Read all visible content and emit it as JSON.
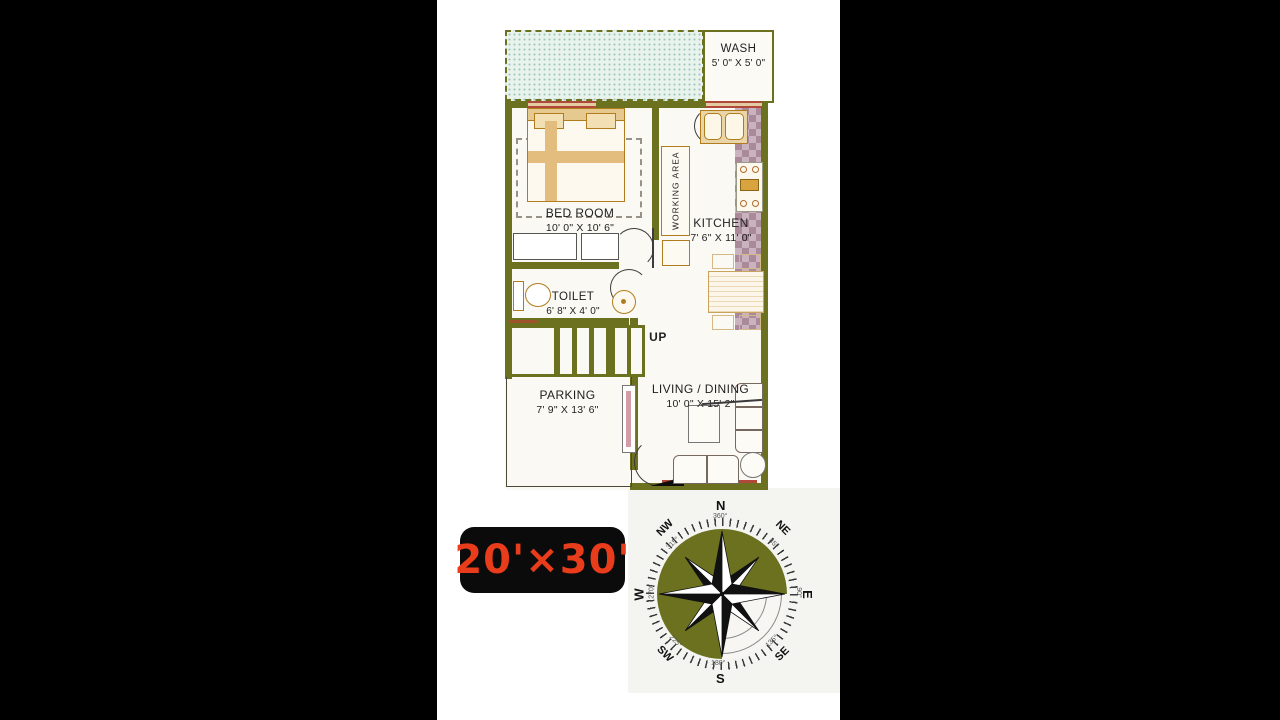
{
  "frame": {
    "background": "#000000",
    "panel_background": "#ffffff"
  },
  "plan": {
    "rooms": {
      "wash": {
        "name": "WASH",
        "dims": "5' 0\" X 5' 0\""
      },
      "bedroom": {
        "name": "BED ROOM",
        "dims": "10' 0\" X 10' 6\""
      },
      "working_area": {
        "name": "WORKING AREA"
      },
      "kitchen": {
        "name": "KITCHEN",
        "dims": "7' 6\" X 11' 0\""
      },
      "toilet": {
        "name": "TOILET",
        "dims": "6' 8\" X 4' 0\""
      },
      "parking": {
        "name": "PARKING",
        "dims": "7' 9\" X 13' 6\""
      },
      "living_dining": {
        "name": "LIVING / DINING",
        "dims": "10' 0\" X 15' 2\""
      }
    },
    "stairs": {
      "label": "UP"
    },
    "colors": {
      "wall": "#6c7120",
      "floor": "#fbf9f3",
      "window_accent": "#b0493a",
      "furniture_outline": "#b07c1e",
      "counter_dark": "#a9899a",
      "counter_light": "#c9b3be",
      "hatch_dot": "#9ec7b9",
      "hatch_bg": "#e9f3ee"
    }
  },
  "size_badge": {
    "text": "20'×30'",
    "text_color": "#e83c1b",
    "background": "#0b0b0b"
  },
  "compass": {
    "disc_color": "#6c7120",
    "directions": {
      "n": {
        "label": "N",
        "degree": "360°"
      },
      "ne": {
        "label": "NE",
        "degree": "45°"
      },
      "e": {
        "label": "E",
        "degree": "90°"
      },
      "se": {
        "label": "SE",
        "degree": "135°"
      },
      "s": {
        "label": "S",
        "degree": "180°"
      },
      "sw": {
        "label": "SW",
        "degree": "225°"
      },
      "w": {
        "label": "W",
        "degree": "270°"
      },
      "nw": {
        "label": "NW",
        "degree": "315°"
      }
    }
  }
}
